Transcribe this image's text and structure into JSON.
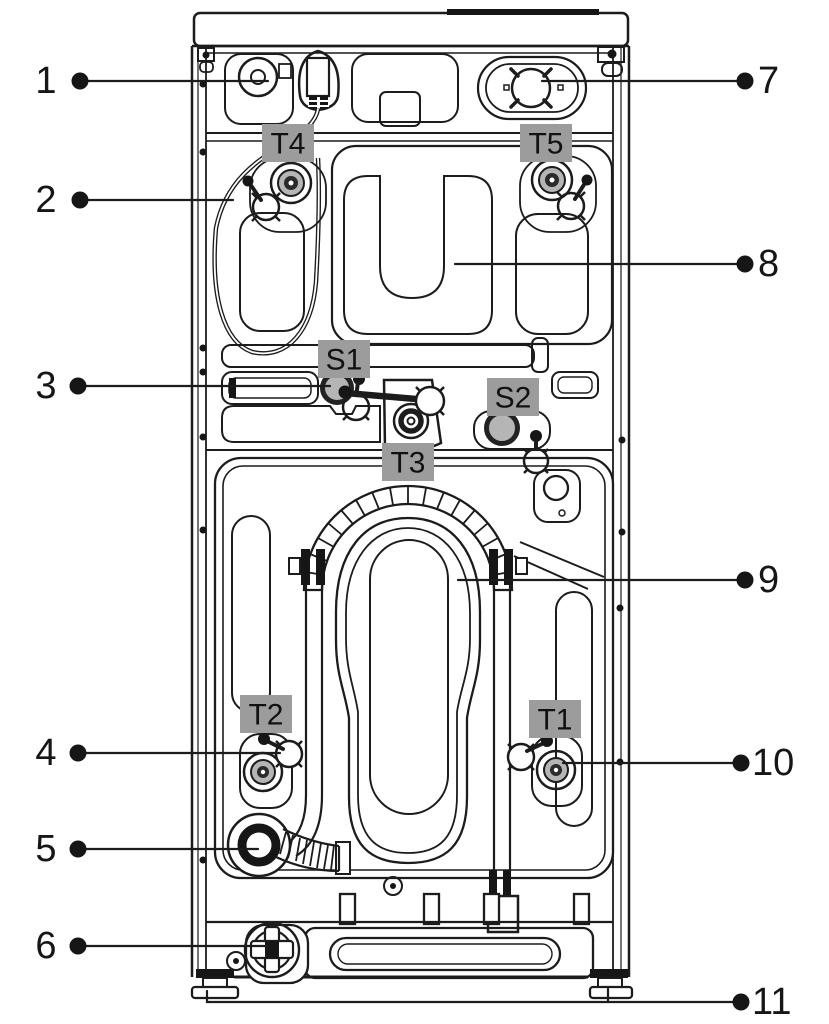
{
  "figure": {
    "colors": {
      "background": "#ffffff",
      "line": "#1c1c1c",
      "tag_background": "#9c9c9c",
      "sensor_fill": "#b5b5b5"
    },
    "callouts": [
      {
        "label": "1"
      },
      {
        "label": "2"
      },
      {
        "label": "3"
      },
      {
        "label": "4"
      },
      {
        "label": "5"
      },
      {
        "label": "6"
      },
      {
        "label": "7"
      },
      {
        "label": "8"
      },
      {
        "label": "9"
      },
      {
        "label": "10"
      },
      {
        "label": "11"
      }
    ],
    "tags": [
      {
        "label": "T4"
      },
      {
        "label": "T5"
      },
      {
        "label": "S1"
      },
      {
        "label": "S2"
      },
      {
        "label": "T3"
      },
      {
        "label": "T2"
      },
      {
        "label": "T1"
      }
    ]
  }
}
